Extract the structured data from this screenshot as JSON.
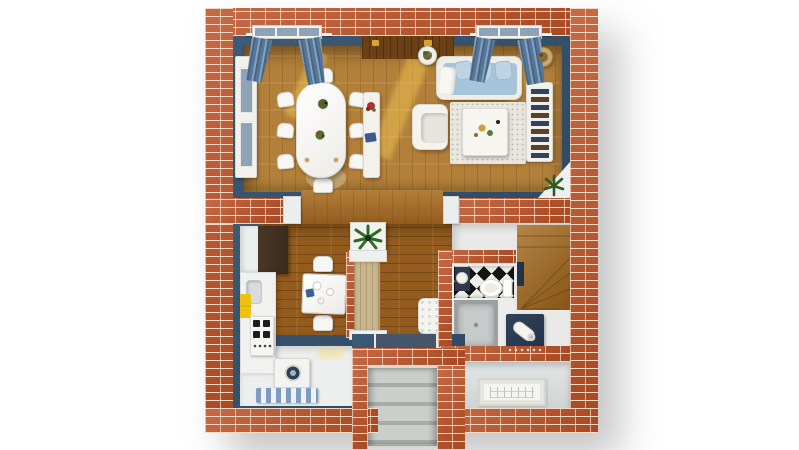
{
  "meta": {
    "description": "3D rendered top-down floor plan of a brick house ground floor",
    "canvas_width": 799,
    "canvas_height": 450,
    "background": "#ffffff",
    "visible_text": []
  },
  "palette": {
    "brick": "#bb5228",
    "mortar": "#f0dcc6",
    "wallBlue": "#3d5a76",
    "wallBlueDark": "#2f4a64",
    "oak": "#b2803a",
    "darkOak": "#935c1e",
    "alcove": "#6b4015",
    "stairWood": "#a36a1e",
    "closetWood": "#c9b68e",
    "offWhite": "#f2f1ec",
    "sofaBlue": "#a7c4da",
    "cushionBlue": "#bcd4e4",
    "curtain": "#54779c",
    "grayPane": "#8fa3b8",
    "sunlight": "#ffd258",
    "stripeBlue": "#7d9cc0",
    "accentYellow": "#eec10c",
    "navy": "#22324a",
    "checker": "#141414",
    "concrete": "#b4b8b4",
    "porch": "#dcdfdf",
    "pantryDark": "#3a2b1d",
    "plantGreen": "#3e6b2a",
    "flowerRed": "#b23030",
    "potTan": "#c9a96a",
    "bookNavy": "#31435c"
  },
  "structure": {
    "exterior_walls": "red brick with cream mortar joints",
    "interior_wall_finish": "steel blue",
    "view": "top-down dollhouse render on white backdrop"
  },
  "rooms": [
    {
      "name": "dining-area",
      "floor": "golden oak planks",
      "items": [
        "white dining table",
        "eight white chairs",
        "flower centerpieces",
        "white display cabinet",
        "white console with red flowers and blue book",
        "window with blue curtains",
        "round beige rug",
        "sunlight patches"
      ]
    },
    {
      "name": "living-area",
      "floor": "golden oak planks",
      "items": [
        "light blue sofa with cushions and white throw",
        "two plant stands",
        "white armchair",
        "white coffee table with decor",
        "speckled area rug",
        "white bookshelf with books",
        "corner plant on white shelf",
        "window with blue curtains",
        "dark wood alcove with two gold ornaments"
      ]
    },
    {
      "name": "kitchen",
      "floor": "white with dark oak dining nook",
      "items": [
        "dark tall cabinet",
        "white counter with sink",
        "stove with four burners",
        "yellow towels",
        "washing machine",
        "blue striped runner rug",
        "white breakfast table with plates",
        "two white chairs"
      ]
    },
    {
      "name": "hallway",
      "floor": "dark oak planks",
      "items": [
        "potted plant on white pedestal",
        "light wood wardrobe with brick trim",
        "white tufted bench",
        "small blue mat"
      ]
    },
    {
      "name": "bathroom",
      "floor": "black and white diamond checker",
      "items": [
        "white toilet",
        "dark corner washbasin",
        "walk-in shower tray",
        "navy vanity with rolled white towel"
      ]
    },
    {
      "name": "staircase",
      "floor": "oak treads",
      "items": [
        "quarter-turn winder staircase"
      ]
    },
    {
      "name": "entry-porch",
      "floor": "light concrete",
      "items": [
        "navy front door",
        "concrete entry steps between brick piers",
        "porch with framed doormat"
      ]
    }
  ]
}
